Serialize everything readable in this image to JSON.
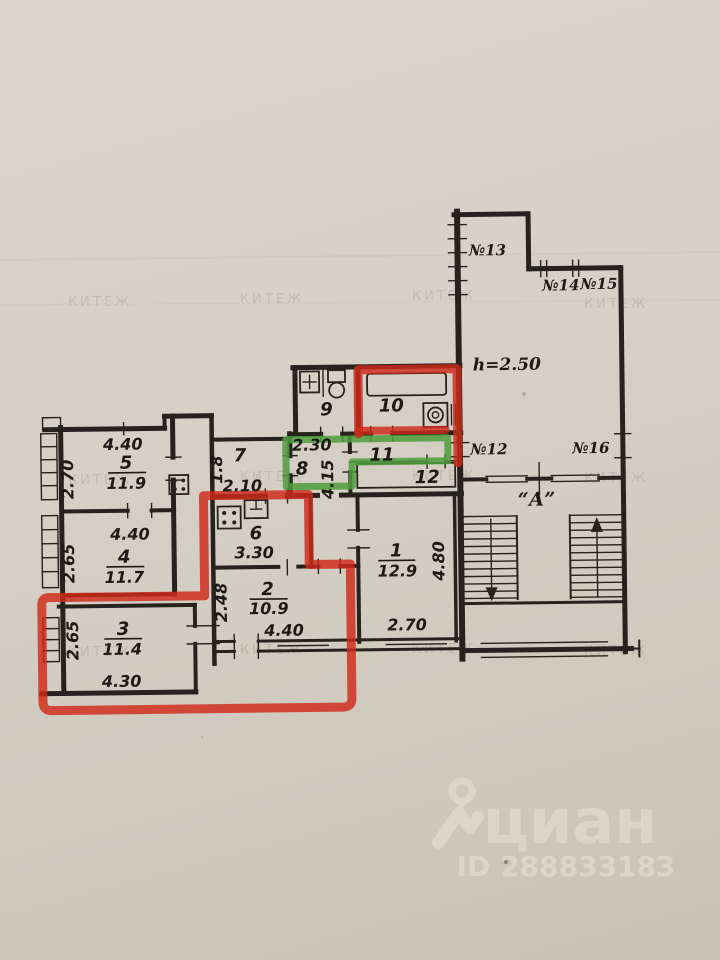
{
  "plan": {
    "rooms": [
      {
        "number": "1",
        "area": "12.9",
        "dim_bottom": "2.70",
        "dim_side": "4.80"
      },
      {
        "number": "2",
        "area": "10.9",
        "dim_bottom": "4.40",
        "dim_side": "2.48"
      },
      {
        "number": "3",
        "area": "11.4",
        "dim_bottom": "4.30",
        "dim_side": "2.65"
      },
      {
        "number": "4",
        "area": "11.7",
        "dim_top": "4.40",
        "dim_side": "2.65"
      },
      {
        "number": "5",
        "area": "11.9",
        "dim_top": "4.40",
        "dim_side": "2.70"
      },
      {
        "number": "6",
        "dim_bottom": "3.30"
      },
      {
        "number": "7",
        "dim_side": "1.8",
        "dim_bottom": "2.10"
      },
      {
        "number": "8",
        "dim_top": "2.30",
        "dim_side": "4.15"
      },
      {
        "number": "9"
      },
      {
        "number": "10"
      },
      {
        "number": "11"
      },
      {
        "number": "12"
      }
    ],
    "windows": [
      {
        "label": "№12"
      },
      {
        "label": "№13"
      },
      {
        "label": "№14"
      },
      {
        "label": "№15"
      },
      {
        "label": "№16"
      }
    ],
    "ceiling_height": "h=2.50",
    "staircase_label": "“А”",
    "colors": {
      "line": "#26221d",
      "highlight_red": "#d02a1a",
      "highlight_green": "#4f9c3c",
      "paper": "#d6d0c7"
    }
  },
  "watermark": {
    "text": "КИТЕЖ"
  },
  "branding": {
    "logo_text": "циан",
    "listing_id": "ID 288833183"
  }
}
